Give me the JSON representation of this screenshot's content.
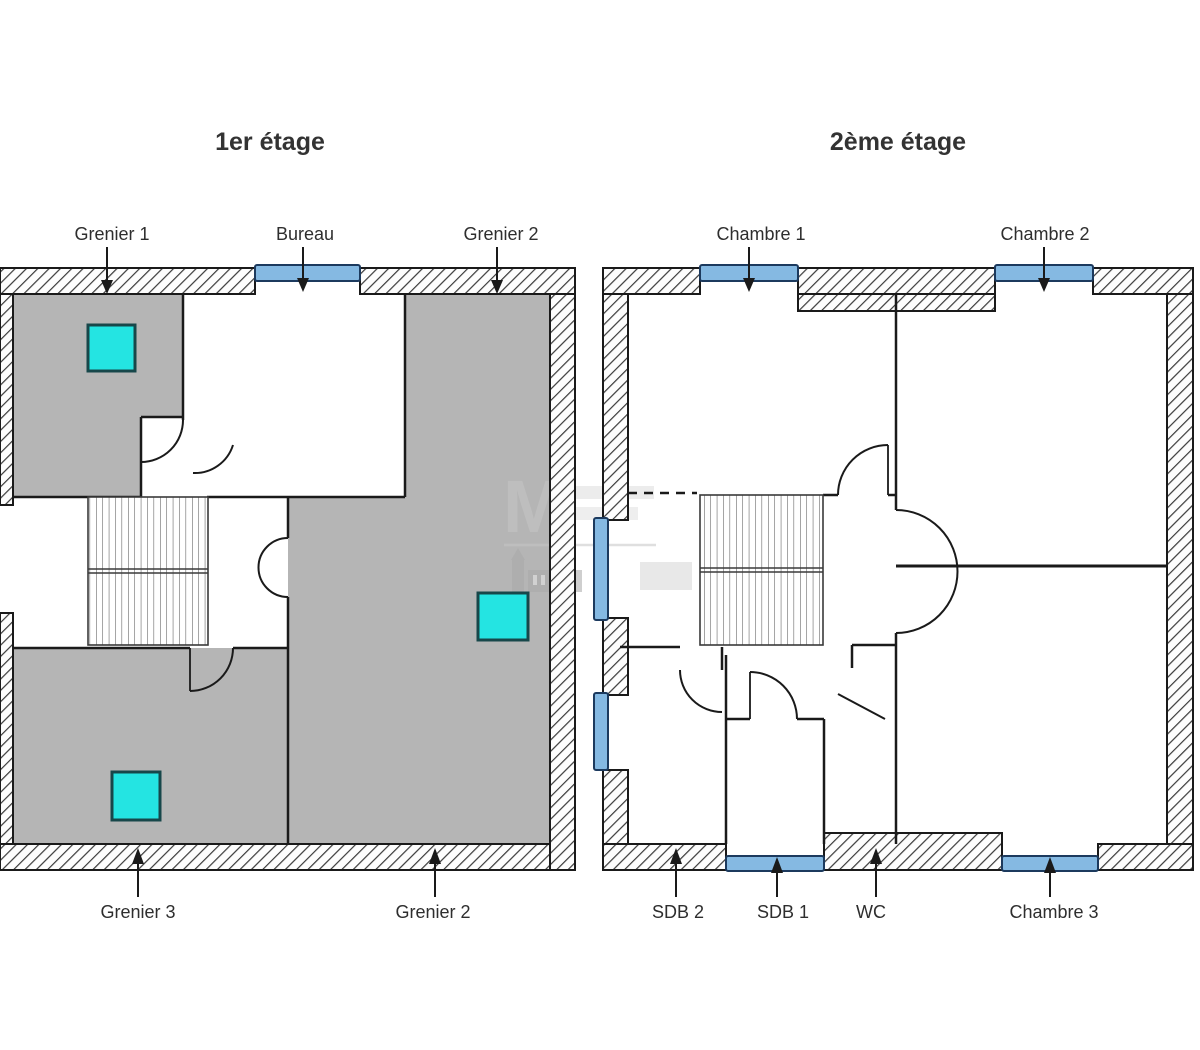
{
  "document_title": "Plans des étages",
  "colors": {
    "wall_line": "#1a1a1a",
    "hatch_line": "#3a3a3a",
    "room_gray": "#b5b5b5",
    "skylight_cyan": "#24e4e2",
    "skylight_border": "#173f45",
    "window_blue": "#85b9e2",
    "window_border": "#1c3a5e",
    "label_text": "#2e2e2e",
    "watermark_gray": "#c6c6c6"
  },
  "plans": [
    {
      "title": "1er étage",
      "labels_top": [
        {
          "text": "Grenier 1"
        },
        {
          "text": "Bureau"
        },
        {
          "text": "Grenier 2"
        }
      ],
      "labels_bottom": [
        {
          "text": "Grenier 3"
        },
        {
          "text": "Grenier 2"
        }
      ]
    },
    {
      "title": "2ème étage",
      "labels_top": [
        {
          "text": "Chambre 1"
        },
        {
          "text": "Chambre 2"
        }
      ],
      "labels_bottom": [
        {
          "text": "SDB 2"
        },
        {
          "text": "SDB 1"
        },
        {
          "text": "WC"
        },
        {
          "text": "Chambre 3"
        }
      ]
    }
  ],
  "watermark": {
    "letter": "M"
  }
}
